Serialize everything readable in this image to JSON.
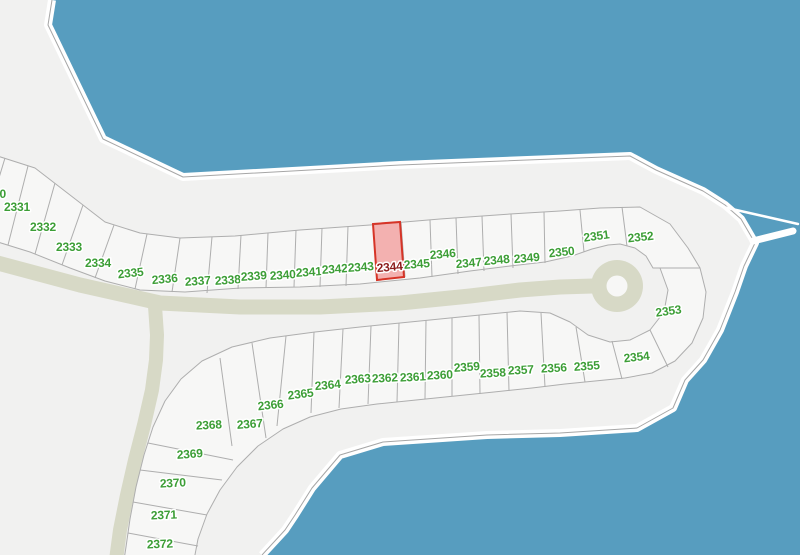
{
  "map": {
    "kind": "residential-parcel-map",
    "colors": {
      "water": "#579dbf",
      "land": "#f1f1f0",
      "lot_fill": "#f7f7f6",
      "road": "#d7d9c6",
      "lot_line": "#aeaeae",
      "shore_line": "#a6a6a6",
      "shore_band": "#ffffff",
      "label_green": "#3c9e36"
    },
    "highlighted_lot": {
      "id": "2344",
      "fill": "rgba(238,90,90,0.45)",
      "stroke": "#d63427",
      "label_color": "#8c1c1c"
    },
    "lots": [
      {
        "id": "2330",
        "x": -7,
        "y": 198,
        "r": 0
      },
      {
        "id": "2331",
        "x": 17,
        "y": 211,
        "r": 0
      },
      {
        "id": "2332",
        "x": 43,
        "y": 231,
        "r": 0
      },
      {
        "id": "2333",
        "x": 69,
        "y": 251,
        "r": 0
      },
      {
        "id": "2334",
        "x": 98,
        "y": 267,
        "r": 0
      },
      {
        "id": "2335",
        "x": 131,
        "y": 277,
        "r": -6
      },
      {
        "id": "2336",
        "x": 165,
        "y": 283,
        "r": -5
      },
      {
        "id": "2337",
        "x": 198,
        "y": 285,
        "r": -4
      },
      {
        "id": "2338",
        "x": 228,
        "y": 284,
        "r": -4
      },
      {
        "id": "2339",
        "x": 254,
        "y": 280,
        "r": -4
      },
      {
        "id": "2340",
        "x": 283,
        "y": 279,
        "r": -4
      },
      {
        "id": "2341",
        "x": 309,
        "y": 276,
        "r": -4
      },
      {
        "id": "2342",
        "x": 335,
        "y": 273,
        "r": -4
      },
      {
        "id": "2343",
        "x": 361,
        "y": 271,
        "r": -4
      },
      {
        "id": "2344",
        "x": 390,
        "y": 271,
        "r": -5
      },
      {
        "id": "2345",
        "x": 417,
        "y": 268,
        "r": -4
      },
      {
        "id": "2346",
        "x": 443,
        "y": 258,
        "r": -5
      },
      {
        "id": "2347",
        "x": 469,
        "y": 267,
        "r": -5
      },
      {
        "id": "2348",
        "x": 497,
        "y": 264,
        "r": -5
      },
      {
        "id": "2349",
        "x": 527,
        "y": 262,
        "r": -5
      },
      {
        "id": "2350",
        "x": 562,
        "y": 256,
        "r": -6
      },
      {
        "id": "2351",
        "x": 597,
        "y": 240,
        "r": -8
      },
      {
        "id": "2352",
        "x": 641,
        "y": 241,
        "r": -6
      },
      {
        "id": "2353",
        "x": 669,
        "y": 315,
        "r": -8
      },
      {
        "id": "2354",
        "x": 637,
        "y": 361,
        "r": -6
      },
      {
        "id": "2355",
        "x": 587,
        "y": 370,
        "r": -4
      },
      {
        "id": "2356",
        "x": 554,
        "y": 372,
        "r": -3
      },
      {
        "id": "2357",
        "x": 521,
        "y": 374,
        "r": -3
      },
      {
        "id": "2358",
        "x": 493,
        "y": 377,
        "r": -3
      },
      {
        "id": "2359",
        "x": 467,
        "y": 371,
        "r": -4
      },
      {
        "id": "2360",
        "x": 440,
        "y": 379,
        "r": -3
      },
      {
        "id": "2361",
        "x": 413,
        "y": 381,
        "r": -3
      },
      {
        "id": "2362",
        "x": 385,
        "y": 382,
        "r": -3
      },
      {
        "id": "2363",
        "x": 358,
        "y": 383,
        "r": -4
      },
      {
        "id": "2364",
        "x": 328,
        "y": 389,
        "r": -5
      },
      {
        "id": "2365",
        "x": 301,
        "y": 398,
        "r": -7
      },
      {
        "id": "2366",
        "x": 271,
        "y": 409,
        "r": -6
      },
      {
        "id": "2367",
        "x": 250,
        "y": 428,
        "r": -4
      },
      {
        "id": "2368",
        "x": 209,
        "y": 429,
        "r": -3
      },
      {
        "id": "2369",
        "x": 190,
        "y": 458,
        "r": -4
      },
      {
        "id": "2370",
        "x": 173,
        "y": 487,
        "r": -3
      },
      {
        "id": "2371",
        "x": 164,
        "y": 519,
        "r": -2
      },
      {
        "id": "2372",
        "x": 160,
        "y": 548,
        "r": -2
      }
    ]
  }
}
